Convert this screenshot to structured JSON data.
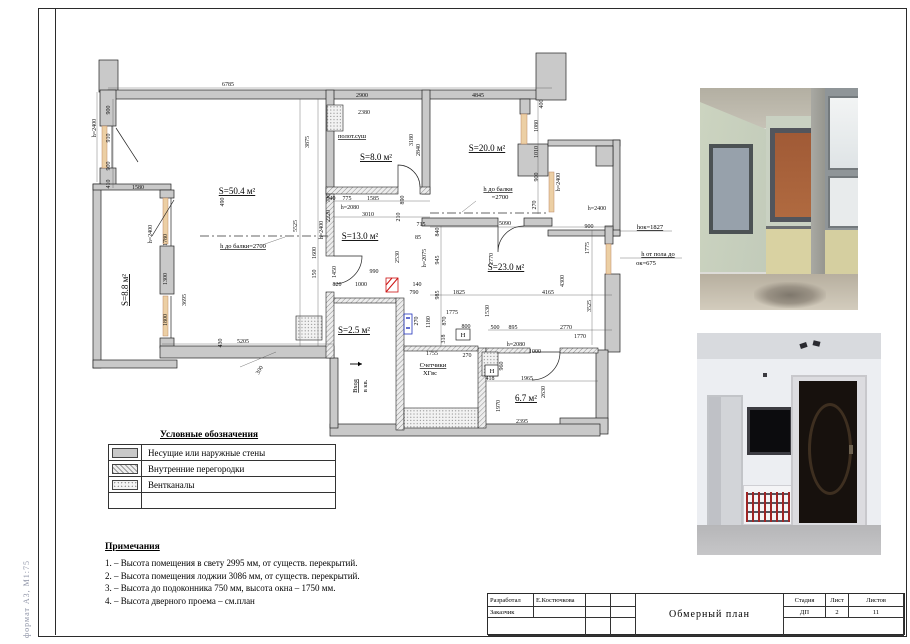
{
  "sheet": {
    "format_label": "формат А3, М1:75"
  },
  "colors": {
    "wall": "#c9c9c9",
    "window_sill": "#eccfa4",
    "door_mark_red": "#cc1111",
    "meter_blue": "#2233bb"
  },
  "plan": {
    "room_labels": [
      {
        "t": "S=50.4 м²",
        "x": 237,
        "y": 194
      },
      {
        "t": "S=8.0 м²",
        "x": 376,
        "y": 160
      },
      {
        "t": "S=20.0 м²",
        "x": 487,
        "y": 151
      },
      {
        "t": "S=13.0 м²",
        "x": 360,
        "y": 239
      },
      {
        "t": "S=23.0 м²",
        "x": 506,
        "y": 270
      },
      {
        "t": "S=2.5 м²",
        "x": 354,
        "y": 333
      },
      {
        "t": "6.7 м²",
        "x": 526,
        "y": 401
      },
      {
        "t": "S=8.8 м²",
        "x": 128,
        "y": 290,
        "r": -90
      }
    ],
    "anno_labels": [
      {
        "t": "h до балки=2700",
        "x": 243,
        "y": 248,
        "u": true
      },
      {
        "t": "h до балки",
        "x": 498,
        "y": 191,
        "u": true
      },
      {
        "t": "=2700",
        "x": 500,
        "y": 199
      },
      {
        "t": "полот.суш",
        "x": 352,
        "y": 138,
        "u": true
      },
      {
        "t": "hок=1827",
        "x": 650,
        "y": 229,
        "u": true
      },
      {
        "t": "h от пола до",
        "x": 658,
        "y": 256,
        "u": true
      },
      {
        "t": "ок=675",
        "x": 646,
        "y": 265
      },
      {
        "t": "Счетчики",
        "x": 433,
        "y": 367,
        "u": true
      },
      {
        "t": "ХГвс",
        "x": 430,
        "y": 375
      },
      {
        "t": "Вход",
        "x": 357,
        "y": 386,
        "r": -90,
        "u": true
      },
      {
        "t": "в кв.",
        "x": 367,
        "y": 386,
        "r": -90
      },
      {
        "t": "H",
        "x": 463,
        "y": 337
      },
      {
        "t": "H",
        "x": 492,
        "y": 373
      }
    ],
    "dim_labels": [
      {
        "t": "6785",
        "x": 228,
        "y": 86
      },
      {
        "t": "900",
        "x": 110,
        "y": 110,
        "r": -90
      },
      {
        "t": "910",
        "x": 110,
        "y": 138,
        "r": -90
      },
      {
        "t": "900",
        "x": 110,
        "y": 166,
        "r": -90
      },
      {
        "t": "410",
        "x": 110,
        "y": 184,
        "r": -90
      },
      {
        "t": "h=2400",
        "x": 96,
        "y": 128,
        "r": -90
      },
      {
        "t": "1580",
        "x": 138,
        "y": 189
      },
      {
        "t": "490",
        "x": 224,
        "y": 202,
        "r": -90
      },
      {
        "t": "h=2400",
        "x": 152,
        "y": 234,
        "r": -90
      },
      {
        "t": "1780",
        "x": 167,
        "y": 240,
        "r": -90
      },
      {
        "t": "1300",
        "x": 167,
        "y": 279,
        "r": -90
      },
      {
        "t": "1800",
        "x": 167,
        "y": 320,
        "r": -90
      },
      {
        "t": "3695",
        "x": 186,
        "y": 300,
        "r": -90
      },
      {
        "t": "5205",
        "x": 243,
        "y": 343
      },
      {
        "t": "430",
        "x": 222,
        "y": 343,
        "r": -90
      },
      {
        "t": "300",
        "x": 261,
        "y": 371,
        "r": -60
      },
      {
        "t": "5525",
        "x": 297,
        "y": 226,
        "r": -90
      },
      {
        "t": "3875",
        "x": 309,
        "y": 142,
        "r": -90
      },
      {
        "t": "1600",
        "x": 316,
        "y": 253,
        "r": -90
      },
      {
        "t": "150",
        "x": 316,
        "y": 274,
        "r": -90
      },
      {
        "t": "h=2400",
        "x": 323,
        "y": 230,
        "r": -90
      },
      {
        "t": "730",
        "x": 330,
        "y": 198,
        "r": -90
      },
      {
        "t": "2220",
        "x": 330,
        "y": 216,
        "r": -90
      },
      {
        "t": "2900",
        "x": 362,
        "y": 97
      },
      {
        "t": "2380",
        "x": 364,
        "y": 114
      },
      {
        "t": "2840",
        "x": 420,
        "y": 150,
        "r": -90
      },
      {
        "t": "3180",
        "x": 413,
        "y": 140,
        "r": -90
      },
      {
        "t": "540",
        "x": 331,
        "y": 200
      },
      {
        "t": "775",
        "x": 347,
        "y": 200
      },
      {
        "t": "1585",
        "x": 373,
        "y": 200
      },
      {
        "t": "h=2080",
        "x": 350,
        "y": 209
      },
      {
        "t": "3010",
        "x": 368,
        "y": 216
      },
      {
        "t": "890",
        "x": 404,
        "y": 200,
        "r": -90
      },
      {
        "t": "210",
        "x": 400,
        "y": 217,
        "r": -90
      },
      {
        "t": "4845",
        "x": 478,
        "y": 97
      },
      {
        "t": "400",
        "x": 543,
        "y": 104,
        "r": -90
      },
      {
        "t": "1080",
        "x": 538,
        "y": 126,
        "r": -90
      },
      {
        "t": "1010",
        "x": 538,
        "y": 152,
        "r": -90
      },
      {
        "t": "900",
        "x": 538,
        "y": 177,
        "r": -90
      },
      {
        "t": "270",
        "x": 536,
        "y": 205,
        "r": -90
      },
      {
        "t": "h=2400",
        "x": 560,
        "y": 182,
        "r": -90
      },
      {
        "t": "715",
        "x": 421,
        "y": 226
      },
      {
        "t": "5090",
        "x": 505,
        "y": 225
      },
      {
        "t": "900",
        "x": 589,
        "y": 228
      },
      {
        "t": "h=2400",
        "x": 597,
        "y": 210
      },
      {
        "t": "85",
        "x": 418,
        "y": 239
      },
      {
        "t": "840",
        "x": 439,
        "y": 232,
        "r": -90
      },
      {
        "t": "h=2075",
        "x": 426,
        "y": 258,
        "r": -90
      },
      {
        "t": "945",
        "x": 439,
        "y": 260,
        "r": -90
      },
      {
        "t": "985",
        "x": 439,
        "y": 295,
        "r": -90
      },
      {
        "t": "2770",
        "x": 493,
        "y": 259,
        "r": -90
      },
      {
        "t": "4300",
        "x": 564,
        "y": 281,
        "r": -90
      },
      {
        "t": "1775",
        "x": 589,
        "y": 248,
        "r": -90
      },
      {
        "t": "1825",
        "x": 459,
        "y": 294
      },
      {
        "t": "4165",
        "x": 548,
        "y": 294
      },
      {
        "t": "3525",
        "x": 591,
        "y": 306,
        "r": -90
      },
      {
        "t": "1530",
        "x": 489,
        "y": 311,
        "r": -90
      },
      {
        "t": "500",
        "x": 495,
        "y": 329
      },
      {
        "t": "895",
        "x": 513,
        "y": 329
      },
      {
        "t": "2770",
        "x": 566,
        "y": 329
      },
      {
        "t": "1770",
        "x": 580,
        "y": 338
      },
      {
        "t": "h=2080",
        "x": 516,
        "y": 346
      },
      {
        "t": "1000",
        "x": 535,
        "y": 353
      },
      {
        "t": "960",
        "x": 503,
        "y": 366,
        "r": -90
      },
      {
        "t": "418",
        "x": 490,
        "y": 380
      },
      {
        "t": "1965",
        "x": 527,
        "y": 380
      },
      {
        "t": "2630",
        "x": 545,
        "y": 392,
        "r": -90
      },
      {
        "t": "1970",
        "x": 500,
        "y": 406,
        "r": -90
      },
      {
        "t": "2395",
        "x": 522,
        "y": 423
      },
      {
        "t": "1450",
        "x": 336,
        "y": 272,
        "r": -90
      },
      {
        "t": "2530",
        "x": 399,
        "y": 257,
        "r": -90
      },
      {
        "t": "820",
        "x": 337,
        "y": 286
      },
      {
        "t": "1000",
        "x": 361,
        "y": 286
      },
      {
        "t": "990",
        "x": 374,
        "y": 273
      },
      {
        "t": "140",
        "x": 417,
        "y": 286
      },
      {
        "t": "790",
        "x": 414,
        "y": 294
      },
      {
        "t": "270",
        "x": 418,
        "y": 321,
        "r": -90
      },
      {
        "t": "1180",
        "x": 430,
        "y": 322,
        "r": -90
      },
      {
        "t": "870",
        "x": 446,
        "y": 321,
        "r": -90
      },
      {
        "t": "318",
        "x": 445,
        "y": 339,
        "r": -90
      },
      {
        "t": "1775",
        "x": 452,
        "y": 314
      },
      {
        "t": "800",
        "x": 466,
        "y": 328
      },
      {
        "t": "1755",
        "x": 432,
        "y": 355
      },
      {
        "t": "270",
        "x": 467,
        "y": 357
      }
    ]
  },
  "legend": {
    "title": "Условные обозначения",
    "items": [
      {
        "label": "Несущие или наружные стены",
        "swatch": "solid"
      },
      {
        "label": "Внутренние перегородки",
        "swatch": "hatch"
      },
      {
        "label": "Вентканалы",
        "swatch": "dots"
      }
    ]
  },
  "notes": {
    "title": "Примечания",
    "items": [
      "1.  –  Высота помещения в свету 2995 мм, от существ. перекрытий.",
      "2.  –  Высота помещения лоджии 3086 мм, от существ. перекрытий.",
      "3.  –  Высота до подоконника 750 мм, высота окна  –  1750 мм.",
      "4.  –  Высота дверного проема  –  см.план"
    ]
  },
  "titleblock": {
    "developed_label": "Разработал",
    "developed_by": "Е.Костючкова",
    "customer_label": "Заказчик",
    "doc_title": "Обмерный план",
    "stage_label": "Стадия",
    "sheet_label": "Лист",
    "sheets_label": "Листов",
    "stage": "ДП",
    "sheet": "2",
    "sheets": "11"
  }
}
